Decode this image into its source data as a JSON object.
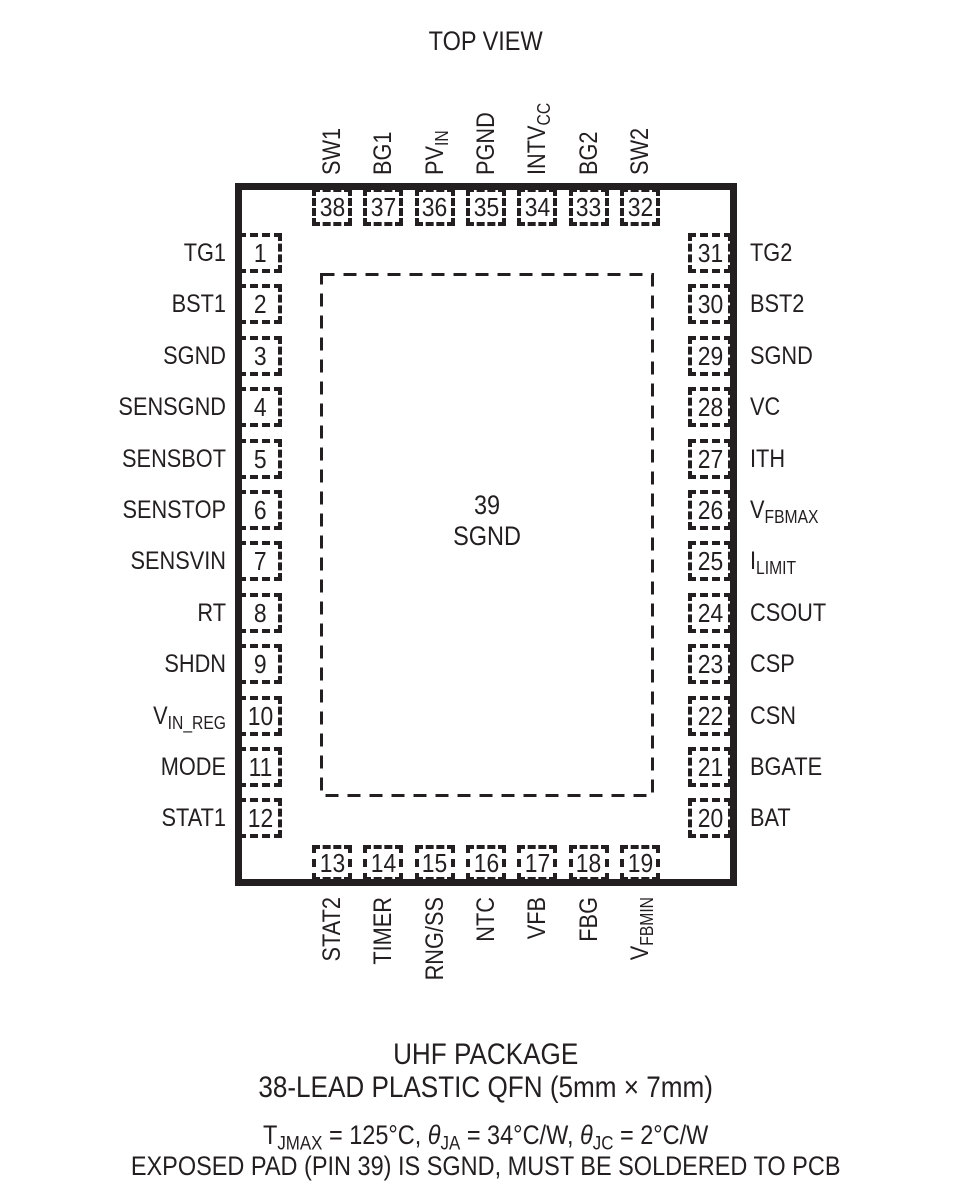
{
  "title": "TOP VIEW",
  "package": {
    "exposed_pad": {
      "number": "39",
      "label": "SGND"
    },
    "pins": {
      "top": [
        {
          "num": "38",
          "parts": [
            {
              "t": "SW1"
            }
          ]
        },
        {
          "num": "37",
          "parts": [
            {
              "t": "BG1"
            }
          ]
        },
        {
          "num": "36",
          "parts": [
            {
              "t": "PV"
            },
            {
              "t": "IN",
              "sub": true
            }
          ]
        },
        {
          "num": "35",
          "parts": [
            {
              "t": "PGND"
            }
          ]
        },
        {
          "num": "34",
          "parts": [
            {
              "t": "INTV"
            },
            {
              "t": "CC",
              "sub": true
            }
          ]
        },
        {
          "num": "33",
          "parts": [
            {
              "t": "BG2"
            }
          ]
        },
        {
          "num": "32",
          "parts": [
            {
              "t": "SW2"
            }
          ]
        }
      ],
      "left": [
        {
          "num": "1",
          "parts": [
            {
              "t": "TG1"
            }
          ]
        },
        {
          "num": "2",
          "parts": [
            {
              "t": "BST1"
            }
          ]
        },
        {
          "num": "3",
          "parts": [
            {
              "t": "SGND"
            }
          ]
        },
        {
          "num": "4",
          "parts": [
            {
              "t": "SENSGND"
            }
          ]
        },
        {
          "num": "5",
          "parts": [
            {
              "t": "SENSBOT"
            }
          ]
        },
        {
          "num": "6",
          "parts": [
            {
              "t": "SENSTOP"
            }
          ]
        },
        {
          "num": "7",
          "parts": [
            {
              "t": "SENSVIN"
            }
          ]
        },
        {
          "num": "8",
          "parts": [
            {
              "t": "RT"
            }
          ]
        },
        {
          "num": "9",
          "parts": [
            {
              "t": "SHDN"
            }
          ]
        },
        {
          "num": "10",
          "parts": [
            {
              "t": "V"
            },
            {
              "t": "IN_REG",
              "sub": true
            }
          ]
        },
        {
          "num": "11",
          "parts": [
            {
              "t": "MODE"
            }
          ]
        },
        {
          "num": "12",
          "parts": [
            {
              "t": "STAT1"
            }
          ]
        }
      ],
      "right": [
        {
          "num": "31",
          "parts": [
            {
              "t": "TG2"
            }
          ]
        },
        {
          "num": "30",
          "parts": [
            {
              "t": "BST2"
            }
          ]
        },
        {
          "num": "29",
          "parts": [
            {
              "t": "SGND"
            }
          ]
        },
        {
          "num": "28",
          "parts": [
            {
              "t": "VC"
            }
          ]
        },
        {
          "num": "27",
          "parts": [
            {
              "t": "ITH"
            }
          ]
        },
        {
          "num": "26",
          "parts": [
            {
              "t": "V"
            },
            {
              "t": "FBMAX",
              "sub": true
            }
          ]
        },
        {
          "num": "25",
          "parts": [
            {
              "t": "I"
            },
            {
              "t": "LIMIT",
              "sub": true
            }
          ]
        },
        {
          "num": "24",
          "parts": [
            {
              "t": "CSOUT"
            }
          ]
        },
        {
          "num": "23",
          "parts": [
            {
              "t": "CSP"
            }
          ]
        },
        {
          "num": "22",
          "parts": [
            {
              "t": "CSN"
            }
          ]
        },
        {
          "num": "21",
          "parts": [
            {
              "t": "BGATE"
            }
          ]
        },
        {
          "num": "20",
          "parts": [
            {
              "t": "BAT"
            }
          ]
        }
      ],
      "bottom": [
        {
          "num": "13",
          "parts": [
            {
              "t": "STAT2"
            }
          ]
        },
        {
          "num": "14",
          "parts": [
            {
              "t": "TIMER"
            }
          ]
        },
        {
          "num": "15",
          "parts": [
            {
              "t": "RNG/SS"
            }
          ]
        },
        {
          "num": "16",
          "parts": [
            {
              "t": "NTC"
            }
          ]
        },
        {
          "num": "17",
          "parts": [
            {
              "t": "VFB"
            }
          ]
        },
        {
          "num": "18",
          "parts": [
            {
              "t": "FBG"
            }
          ]
        },
        {
          "num": "19",
          "parts": [
            {
              "t": "V"
            },
            {
              "t": "FBMIN",
              "sub": true
            }
          ]
        }
      ]
    }
  },
  "footer": {
    "package_name": "UHF PACKAGE",
    "package_desc": "38-LEAD PLASTIC QFN (5mm × 7mm)",
    "thermal_parts": [
      {
        "t": "T"
      },
      {
        "t": "JMAX",
        "sub": true
      },
      {
        "t": " = 125°C, "
      },
      {
        "t": "θ",
        "i": true
      },
      {
        "t": "JA",
        "sub": true
      },
      {
        "t": " = 34°C/W, "
      },
      {
        "t": "θ",
        "i": true
      },
      {
        "t": "JC",
        "sub": true
      },
      {
        "t": " = 2°C/W"
      }
    ],
    "note": "EXPOSED PAD (PIN 39) IS SGND, MUST BE SOLDERED TO PCB"
  },
  "colors": {
    "ink": "#231f20",
    "background": "#ffffff"
  }
}
